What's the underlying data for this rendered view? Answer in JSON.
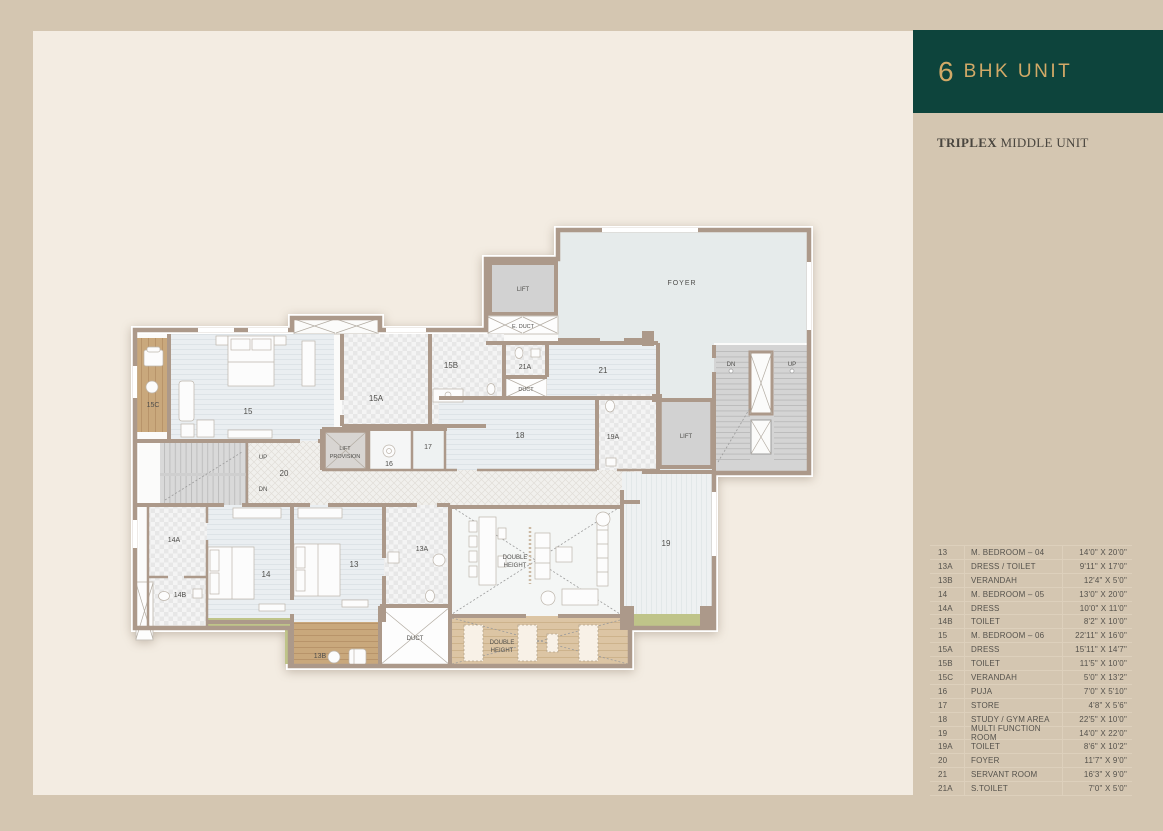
{
  "sidebar": {
    "header": {
      "number": "6",
      "title": "BHK UNIT",
      "bg": "#0D443C",
      "fg": "#D2A967"
    },
    "subtitle": {
      "bold": "TRIPLEX",
      "rest": " MIDDLE UNIT"
    },
    "legend": {
      "rows": [
        {
          "id": "13",
          "name": "M. BEDROOM – 04",
          "dim": "14'0\" X 20'0\""
        },
        {
          "id": "13A",
          "name": "DRESS / TOILET",
          "dim": "9'11\" X 17'0\""
        },
        {
          "id": "13B",
          "name": "VERANDAH",
          "dim": "12'4\" X 5'0\""
        },
        {
          "id": "14",
          "name": "M. BEDROOM – 05",
          "dim": "13'0\" X 20'0\""
        },
        {
          "id": "14A",
          "name": "DRESS",
          "dim": "10'0\" X 11'0\""
        },
        {
          "id": "14B",
          "name": "TOILET",
          "dim": "8'2\" X 10'0\""
        },
        {
          "id": "15",
          "name": "M. BEDROOM – 06",
          "dim": "22'11\" X 16'0\""
        },
        {
          "id": "15A",
          "name": "DRESS",
          "dim": "15'11\" X 14'7\""
        },
        {
          "id": "15B",
          "name": "TOILET",
          "dim": "11'5\" X 10'0\""
        },
        {
          "id": "15C",
          "name": "VERANDAH",
          "dim": "5'0\" X 13'2\""
        },
        {
          "id": "16",
          "name": "PUJA",
          "dim": "7'0\" X 5'10\""
        },
        {
          "id": "17",
          "name": "STORE",
          "dim": "4'8\" X 5'6\""
        },
        {
          "id": "18",
          "name": "STUDY / GYM AREA",
          "dim": "22'5\" X 10'0\""
        },
        {
          "id": "19",
          "name": "MULTI FUNCTION ROOM",
          "dim": "14'0\" X 22'0\""
        },
        {
          "id": "19A",
          "name": "TOILET",
          "dim": "8'6\" X 10'2\""
        },
        {
          "id": "20",
          "name": "FOYER",
          "dim": "11'7\" X 9'0\""
        },
        {
          "id": "21",
          "name": "SERVANT ROOM",
          "dim": "16'3\" X 9'0\""
        },
        {
          "id": "21A",
          "name": "S.TOILET",
          "dim": "7'0\" X 5'0\""
        }
      ]
    }
  },
  "plan": {
    "labels": {
      "foyer": "FOYER",
      "lift": "LIFT",
      "e_duct": "E. DUCT",
      "duct": "DUCT",
      "provision": "PROVISION",
      "double": "DOUBLE",
      "height": "HEIGHT",
      "dn": "DN",
      "up": "UP",
      "r13": "13",
      "r13a": "13A",
      "r13b": "13B",
      "r14": "14",
      "r14a": "14A",
      "r14b": "14B",
      "r15": "15",
      "r15a": "15A",
      "r15b": "15B",
      "r15c": "15C",
      "r16": "16",
      "r17": "17",
      "r18": "18",
      "r19": "19",
      "r19a": "19A",
      "r20": "20",
      "r21": "21",
      "r21a": "21A"
    },
    "colors": {
      "wall": "#AC998A",
      "foyer_fill": "#E6EBEB",
      "room_fill": "#EAEEF1",
      "green": "#BFC489",
      "wood": "#C9A87C",
      "wood_light": "#DCC5A4",
      "stair": "#D6D6D6",
      "lift_fill": "#D2D2D2",
      "page_bg": "#D4C6B1",
      "panel_bg": "#F3ECE2"
    }
  }
}
